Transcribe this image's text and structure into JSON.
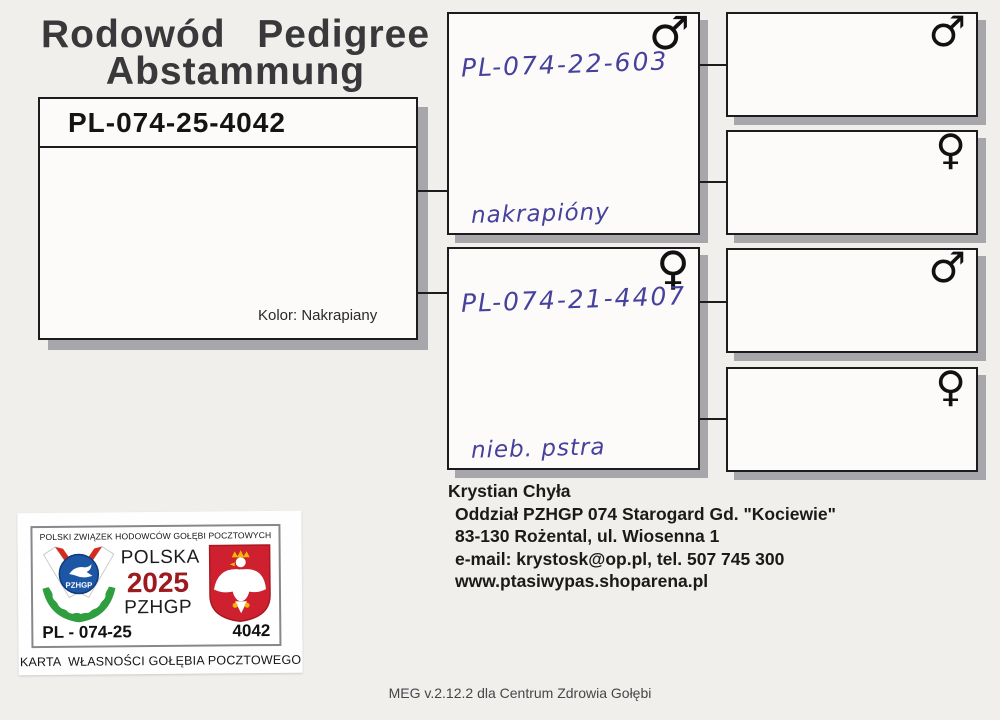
{
  "document": {
    "title_line1": "Rodowód  Pedigree",
    "title_line2": "Abstammung",
    "footer": "MEG v.2.12.2 dla Centrum Zdrowia Gołębi"
  },
  "pedigree": {
    "bird": {
      "ring": "PL-074-25-4042",
      "color_label": "Kolor: Nakrapiany"
    },
    "father": {
      "ring": "PL-074-22-603",
      "sex": "♂",
      "note": "nakrapióny"
    },
    "mother": {
      "ring": "PL-074-21-4407",
      "sex": "♀",
      "note": "nieb. pstra"
    },
    "grandparents": [
      {
        "sex": "♂"
      },
      {
        "sex": "♀"
      },
      {
        "sex": "♂"
      },
      {
        "sex": "♀"
      }
    ]
  },
  "ownership_card": {
    "federation": "POLSKI ZWIĄZEK HODOWCÓW GOŁĘBI POCZTOWYCH",
    "country": "POLSKA",
    "year": "2025",
    "org": "PZHGP",
    "logo_text": "PZHGP",
    "ring_prefix": "PL - 074-25",
    "ring_number": "4042",
    "card_title": "KARTA  WŁASNOŚCI GOŁĘBIA POCZTOWEGO",
    "colors": {
      "shield_red": "#cf2030",
      "disc_blue": "#1d56a5",
      "wreath_green": "#2e9e3e",
      "crown_gold": "#f2b705",
      "year_red": "#9c1b1e"
    }
  },
  "breeder": {
    "name": "Krystian Chyła",
    "lines": [
      "Oddział PZHGP 074 Starogard Gd. \"Kociewie\"",
      "83-130 Rożental, ul. Wiosenna 1",
      "e-mail: krystosk@op.pl, tel. 507 745 300",
      "www.ptasiwypas.shoparena.pl"
    ]
  }
}
